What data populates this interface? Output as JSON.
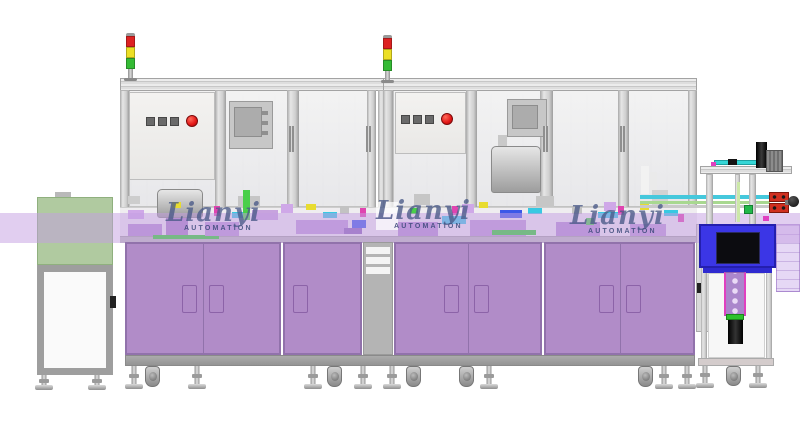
{
  "scene": {
    "width": 800,
    "height": 438,
    "background": "#ffffff",
    "description": "CAD render of an automation assembly machine line"
  },
  "watermark": {
    "brand": "Lianyi",
    "sub": "AUTOMATION",
    "brand_color": "#4a5a88",
    "sub_color": "#2e4070",
    "instances": [
      {
        "x": 166,
        "y": 200,
        "box": false
      },
      {
        "x": 376,
        "y": 198,
        "box": true
      },
      {
        "x": 570,
        "y": 203,
        "box": false
      }
    ]
  },
  "palette": {
    "frame": "#d6d6d6",
    "frame_edge": "#a3a3a3",
    "glass": "#ededed",
    "cabinet_face": "#b18cc8",
    "cabinet_edge": "#9172ab",
    "cabinet_base": "#9c9c9c",
    "band": "rgba(196,158,226,0.5)",
    "conveyor_green": "#a9c698",
    "machine_blue": "#3b36e6",
    "tower_red": "#dd2222",
    "tower_yellow": "#ecdf25",
    "tower_green": "#35bb35",
    "button_red": "#e31616",
    "button_grey": "#6a6a6a"
  },
  "signal_towers": [
    {
      "x": 124,
      "y": 33
    },
    {
      "x": 381,
      "y": 35
    }
  ],
  "bench": {
    "parts": [
      {
        "x": 128,
        "y": 196,
        "w": 12,
        "h": 8,
        "c": "#cdcdcd"
      },
      {
        "x": 128,
        "y": 210,
        "w": 16,
        "h": 9,
        "c": "#cfa8e8"
      },
      {
        "x": 128,
        "y": 224,
        "w": 34,
        "h": 12,
        "c": "#b48fd2"
      },
      {
        "x": 166,
        "y": 218,
        "w": 22,
        "h": 18,
        "c": "#a881c6"
      },
      {
        "x": 172,
        "y": 202,
        "w": 9,
        "h": 6,
        "c": "#e8dc30"
      },
      {
        "x": 153,
        "y": 235,
        "w": 66,
        "h": 4,
        "c": "#2ad42a"
      },
      {
        "x": 205,
        "y": 222,
        "w": 34,
        "h": 14,
        "c": "#bb96d6"
      },
      {
        "x": 214,
        "y": 206,
        "w": 6,
        "h": 10,
        "c": "#e044b0"
      },
      {
        "x": 232,
        "y": 212,
        "w": 18,
        "h": 6,
        "c": "#38c9e2"
      },
      {
        "x": 238,
        "y": 196,
        "w": 22,
        "h": 12,
        "c": "#c6c6c6"
      },
      {
        "x": 243,
        "y": 190,
        "w": 7,
        "h": 30,
        "c": "#49cf49"
      },
      {
        "x": 252,
        "y": 210,
        "w": 26,
        "h": 10,
        "c": "#c7a3de"
      },
      {
        "x": 281,
        "y": 204,
        "w": 12,
        "h": 9,
        "c": "#cfa8e8"
      },
      {
        "x": 296,
        "y": 220,
        "w": 52,
        "h": 14,
        "c": "#bd98d8"
      },
      {
        "x": 306,
        "y": 204,
        "w": 10,
        "h": 6,
        "c": "#e8dc30"
      },
      {
        "x": 323,
        "y": 212,
        "w": 14,
        "h": 6,
        "c": "#38c9e2"
      },
      {
        "x": 340,
        "y": 206,
        "w": 9,
        "h": 8,
        "c": "#c2c2c2"
      },
      {
        "x": 344,
        "y": 228,
        "w": 18,
        "h": 6,
        "c": "#8a64b8"
      },
      {
        "x": 352,
        "y": 220,
        "w": 14,
        "h": 8,
        "c": "#3b58e8"
      },
      {
        "x": 360,
        "y": 208,
        "w": 6,
        "h": 9,
        "c": "#e044b0"
      },
      {
        "x": 398,
        "y": 222,
        "w": 40,
        "h": 14,
        "c": "#b48fd2"
      },
      {
        "x": 410,
        "y": 208,
        "w": 8,
        "h": 6,
        "c": "#49cf49"
      },
      {
        "x": 414,
        "y": 194,
        "w": 16,
        "h": 11,
        "c": "#c6c6c6"
      },
      {
        "x": 442,
        "y": 216,
        "w": 24,
        "h": 8,
        "c": "#38c9e2"
      },
      {
        "x": 452,
        "y": 206,
        "w": 6,
        "h": 9,
        "c": "#e044b0"
      },
      {
        "x": 462,
        "y": 204,
        "w": 12,
        "h": 9,
        "c": "#cfa8e8"
      },
      {
        "x": 470,
        "y": 220,
        "w": 56,
        "h": 16,
        "c": "#bd98d6"
      },
      {
        "x": 479,
        "y": 202,
        "w": 9,
        "h": 6,
        "c": "#e8dc30"
      },
      {
        "x": 492,
        "y": 230,
        "w": 44,
        "h": 5,
        "c": "#2ad42a"
      },
      {
        "x": 500,
        "y": 210,
        "w": 22,
        "h": 8,
        "c": "#3b58e8"
      },
      {
        "x": 528,
        "y": 208,
        "w": 14,
        "h": 6,
        "c": "#38c9e2"
      },
      {
        "x": 536,
        "y": 196,
        "w": 18,
        "h": 11,
        "c": "#c6c6c6"
      },
      {
        "x": 556,
        "y": 222,
        "w": 44,
        "h": 14,
        "c": "#b48fd2"
      },
      {
        "x": 572,
        "y": 206,
        "w": 10,
        "h": 8,
        "c": "#c2c2c2"
      },
      {
        "x": 586,
        "y": 218,
        "w": 8,
        "h": 7,
        "c": "#49cf49"
      },
      {
        "x": 598,
        "y": 212,
        "w": 20,
        "h": 6,
        "c": "#38c9e2"
      },
      {
        "x": 604,
        "y": 202,
        "w": 12,
        "h": 9,
        "c": "#cfa8e8"
      },
      {
        "x": 618,
        "y": 206,
        "w": 6,
        "h": 9,
        "c": "#e044b0"
      },
      {
        "x": 630,
        "y": 224,
        "w": 36,
        "h": 12,
        "c": "#bd98d6"
      },
      {
        "x": 640,
        "y": 204,
        "w": 9,
        "h": 6,
        "c": "#e8dc30"
      },
      {
        "x": 641,
        "y": 166,
        "w": 8,
        "h": 28,
        "c": "#f2f2f2",
        "n": "bottle"
      },
      {
        "x": 650,
        "y": 172,
        "w": 7,
        "h": 22,
        "c": "#eaeaea",
        "n": "bottle"
      },
      {
        "x": 652,
        "y": 190,
        "w": 16,
        "h": 16,
        "c": "#d2d2d2"
      },
      {
        "x": 664,
        "y": 210,
        "w": 14,
        "h": 6,
        "c": "#38c9e2"
      },
      {
        "x": 678,
        "y": 214,
        "w": 6,
        "h": 8,
        "c": "#e044b0"
      }
    ]
  },
  "cabinets": {
    "face": "#b18cc8",
    "edge": "#9172ab",
    "slot_light": "#f4e9fb",
    "slot_dark": "#6d4690",
    "y": 242,
    "h": 113,
    "groups": [
      {
        "x": 125,
        "w": 156,
        "splits": [
          203
        ],
        "handles": [
          {
            "x": 182,
            "slot": "light"
          },
          {
            "x": 209,
            "slot": "dark"
          }
        ]
      },
      {
        "x": 283,
        "w": 79,
        "splits": [],
        "handles": [
          {
            "x": 293,
            "slot": "dark"
          }
        ]
      },
      {
        "x": 394,
        "w": 148,
        "splits": [
          468
        ],
        "handles": [
          {
            "x": 444,
            "slot": "light"
          },
          {
            "x": 474,
            "slot": "dark"
          }
        ]
      },
      {
        "x": 544,
        "w": 151,
        "splits": [
          620
        ],
        "handles": [
          {
            "x": 599,
            "slot": "light"
          },
          {
            "x": 626,
            "slot": "dark"
          }
        ]
      }
    ]
  },
  "feet": {
    "items": [
      {
        "x": 44,
        "t": "lev",
        "y": 375,
        "h": 15
      },
      {
        "x": 97,
        "t": "lev",
        "y": 375,
        "h": 15
      },
      {
        "x": 134,
        "t": "lev",
        "y": 366,
        "h": 23
      },
      {
        "x": 152,
        "t": "cas",
        "y": 366,
        "h": 21
      },
      {
        "x": 197,
        "t": "lev",
        "y": 366,
        "h": 23
      },
      {
        "x": 313,
        "t": "lev",
        "y": 366,
        "h": 23
      },
      {
        "x": 334,
        "t": "cas",
        "y": 366,
        "h": 21
      },
      {
        "x": 363,
        "t": "lev",
        "y": 366,
        "h": 23
      },
      {
        "x": 392,
        "t": "lev",
        "y": 366,
        "h": 23
      },
      {
        "x": 413,
        "t": "cas",
        "y": 366,
        "h": 21
      },
      {
        "x": 466,
        "t": "cas",
        "y": 366,
        "h": 21
      },
      {
        "x": 489,
        "t": "lev",
        "y": 366,
        "h": 23
      },
      {
        "x": 645,
        "t": "cas",
        "y": 366,
        "h": 21
      },
      {
        "x": 664,
        "t": "lev",
        "y": 366,
        "h": 23
      },
      {
        "x": 687,
        "t": "lev",
        "y": 366,
        "h": 23
      },
      {
        "x": 705,
        "t": "lev",
        "y": 366,
        "h": 22
      },
      {
        "x": 733,
        "t": "cas",
        "y": 366,
        "h": 20
      },
      {
        "x": 758,
        "t": "lev",
        "y": 366,
        "h": 22
      }
    ]
  }
}
